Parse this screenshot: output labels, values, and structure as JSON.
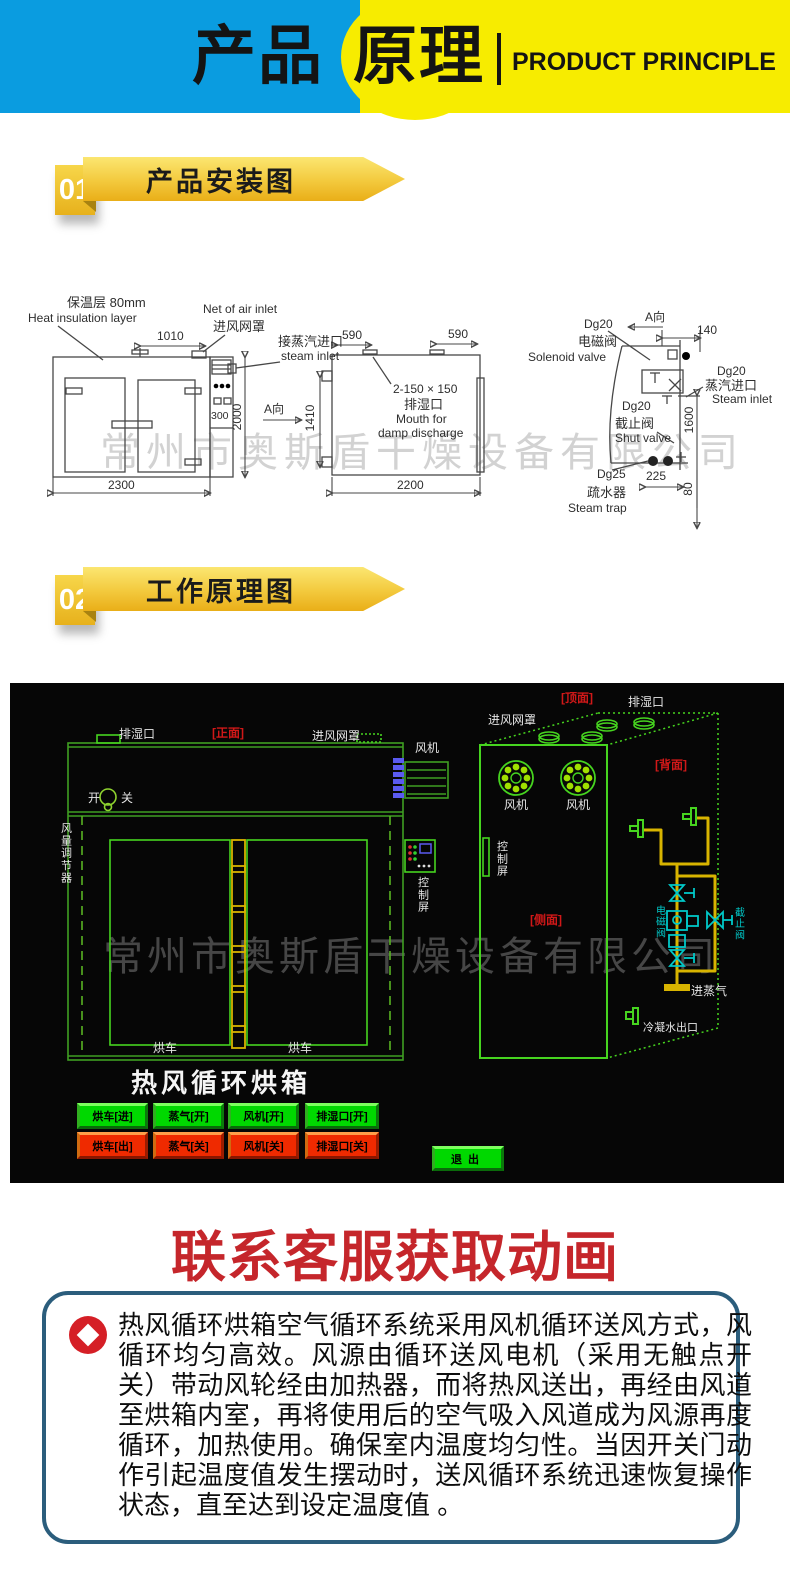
{
  "header": {
    "title_cn_left": "产品",
    "title_cn_right": "原理",
    "title_en": "PRODUCT PRINCIPLE"
  },
  "sections": {
    "s1_num": "01",
    "s1_title": "产品安装图",
    "s2_num": "02",
    "s2_title": "工作原理图"
  },
  "watermark": "常州市奥斯盾干燥设备有限公司",
  "install": {
    "insulation_cn": "保温层 80mm",
    "insulation_en": "Heat insulation layer",
    "net_en": "Net of air inlet",
    "net_cn": "进风网罩",
    "steam_connect_cn": "接蒸汽进口",
    "steam_connect_en": "steam inlet",
    "damp_size": "2-150 × 150",
    "damp_cn": "排湿口",
    "damp_en1": "Mouth for",
    "damp_en2": "damp discharge",
    "a_dir": "A向",
    "dg20": "Dg20",
    "dg25": "Dg25",
    "solenoid_cn": "电磁阀",
    "solenoid_en": "Solenoid valve",
    "steam_inlet_cn": "蒸汽进口",
    "steam_inlet_en": "Steam inlet",
    "shut_cn": "截止阀",
    "shut_en": "Shut valve",
    "trap_cn": "疏水器",
    "trap_en": "Steam trap",
    "dims": {
      "d1010": "1010",
      "d590": "590",
      "d2000": "2000",
      "d300": "300",
      "d2300": "2300",
      "d2200": "2200",
      "d1410": "1410",
      "d140": "140",
      "d1600": "1600",
      "d225": "225",
      "d80": "80"
    }
  },
  "cad": {
    "front": "[正面]",
    "top": "[顶面]",
    "back": "[背面]",
    "side": "[侧面]",
    "damp": "排湿口",
    "inlet_net": "进风网罩",
    "fan": "风机",
    "switch_on": "开",
    "switch_off": "关",
    "regulator": "风量调节器",
    "control": "控制屏",
    "cart": "烘车",
    "solenoid": "电磁阀",
    "shut": "截止阀",
    "steam_in": "进蒸气",
    "condensate": "冷凝水出口",
    "title": "热风循环烘箱",
    "buttons_green": [
      "烘车[进]",
      "蒸气[开]",
      "风机[开]",
      "排湿口[开]"
    ],
    "buttons_red": [
      "烘车[出]",
      "蒸气[关]",
      "风机[关]",
      "排湿口[关]"
    ],
    "exit": "退出"
  },
  "contact": {
    "title": "联系客服获取动画"
  },
  "description": {
    "text": "热风循环烘箱空气循环系统采用风机循环送风方式，风循环均匀高效。风源由循环送风电机（采用无触点开关）带动风轮经由加热器，而将热风送出，再经由风道至烘箱内室，再将使用后的空气吸入风道成为风源再度循环，加热使用。确保室内温度均匀性。当因开关门动作引起温度值发生摆动时，送风循环系统迅速恢复操作状态，直至达到设定温度值 。"
  },
  "colors": {
    "accent_blue": "#0a9ce0",
    "accent_yellow": "#f7ec00",
    "ribbon_gold": "#f3c93d",
    "title_red": "#c5262b",
    "box_border_blue": "#2b5d7c",
    "cad_green": "#46d41f",
    "cad_yellow": "#d8b400",
    "cad_cyan": "#00c8c8",
    "button_green": "#00d800",
    "button_red": "#ef2a00"
  }
}
